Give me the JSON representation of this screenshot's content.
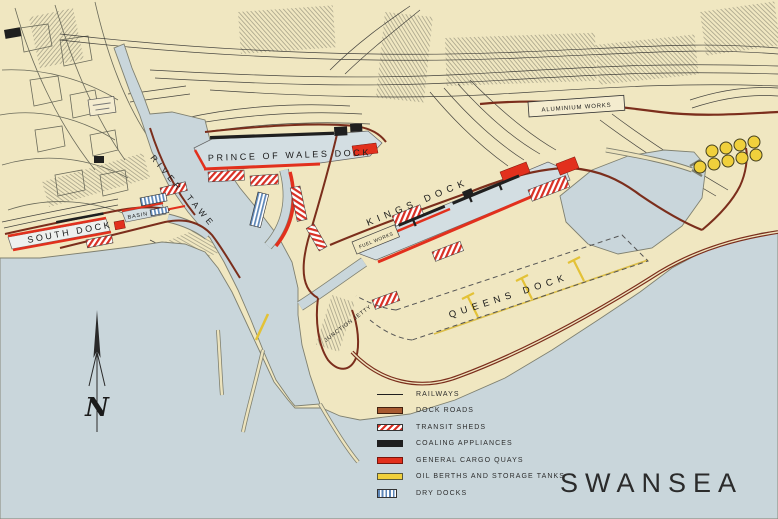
{
  "title": "SWANSEA",
  "map_labels": {
    "south_dock": "SOUTH DOCK",
    "basin": "BASIN",
    "prince_of_wales_dock": "PRINCE OF WALES DOCK",
    "kings_dock": "KINGS DOCK",
    "queens_dock": "QUEENS DOCK",
    "river": "RIVER",
    "tawe": "TAWE",
    "aluminium_works": "ALUMINIUM WORKS",
    "fuel_works": "FUEL WORKS",
    "jetty": "JUNCTION JETTY",
    "north_indicator": "N"
  },
  "legend": {
    "items": [
      {
        "label": "RAILWAYS",
        "swatch": "railways-line"
      },
      {
        "label": "DOCK ROADS",
        "swatch": "dock-roads-swatch"
      },
      {
        "label": "TRANSIT SHEDS",
        "swatch": "transit-sheds-swatch"
      },
      {
        "label": "COALING APPLIANCES",
        "swatch": "coaling-appliances-swatch"
      },
      {
        "label": "GENERAL CARGO QUAYS",
        "swatch": "general-cargo-quays-swatch"
      },
      {
        "label": "OIL BERTHS AND STORAGE TANKS",
        "swatch": "oil-berths-swatch"
      },
      {
        "label": "DRY DOCKS",
        "swatch": "dry-docks-swatch"
      }
    ]
  },
  "colors": {
    "land": "#f0e7c1",
    "water": "#c9d6db",
    "dock_water": "#d3dee2",
    "railway": "#2a2a2a",
    "dock_road": "#7b2e1c",
    "transit_shed_red": "#d93025",
    "coaling_black": "#1f1f1f",
    "cargo_quay_red": "#e2301d",
    "oil_yellow": "#f0d03c",
    "dry_dock_blue": "#5d87b8"
  }
}
